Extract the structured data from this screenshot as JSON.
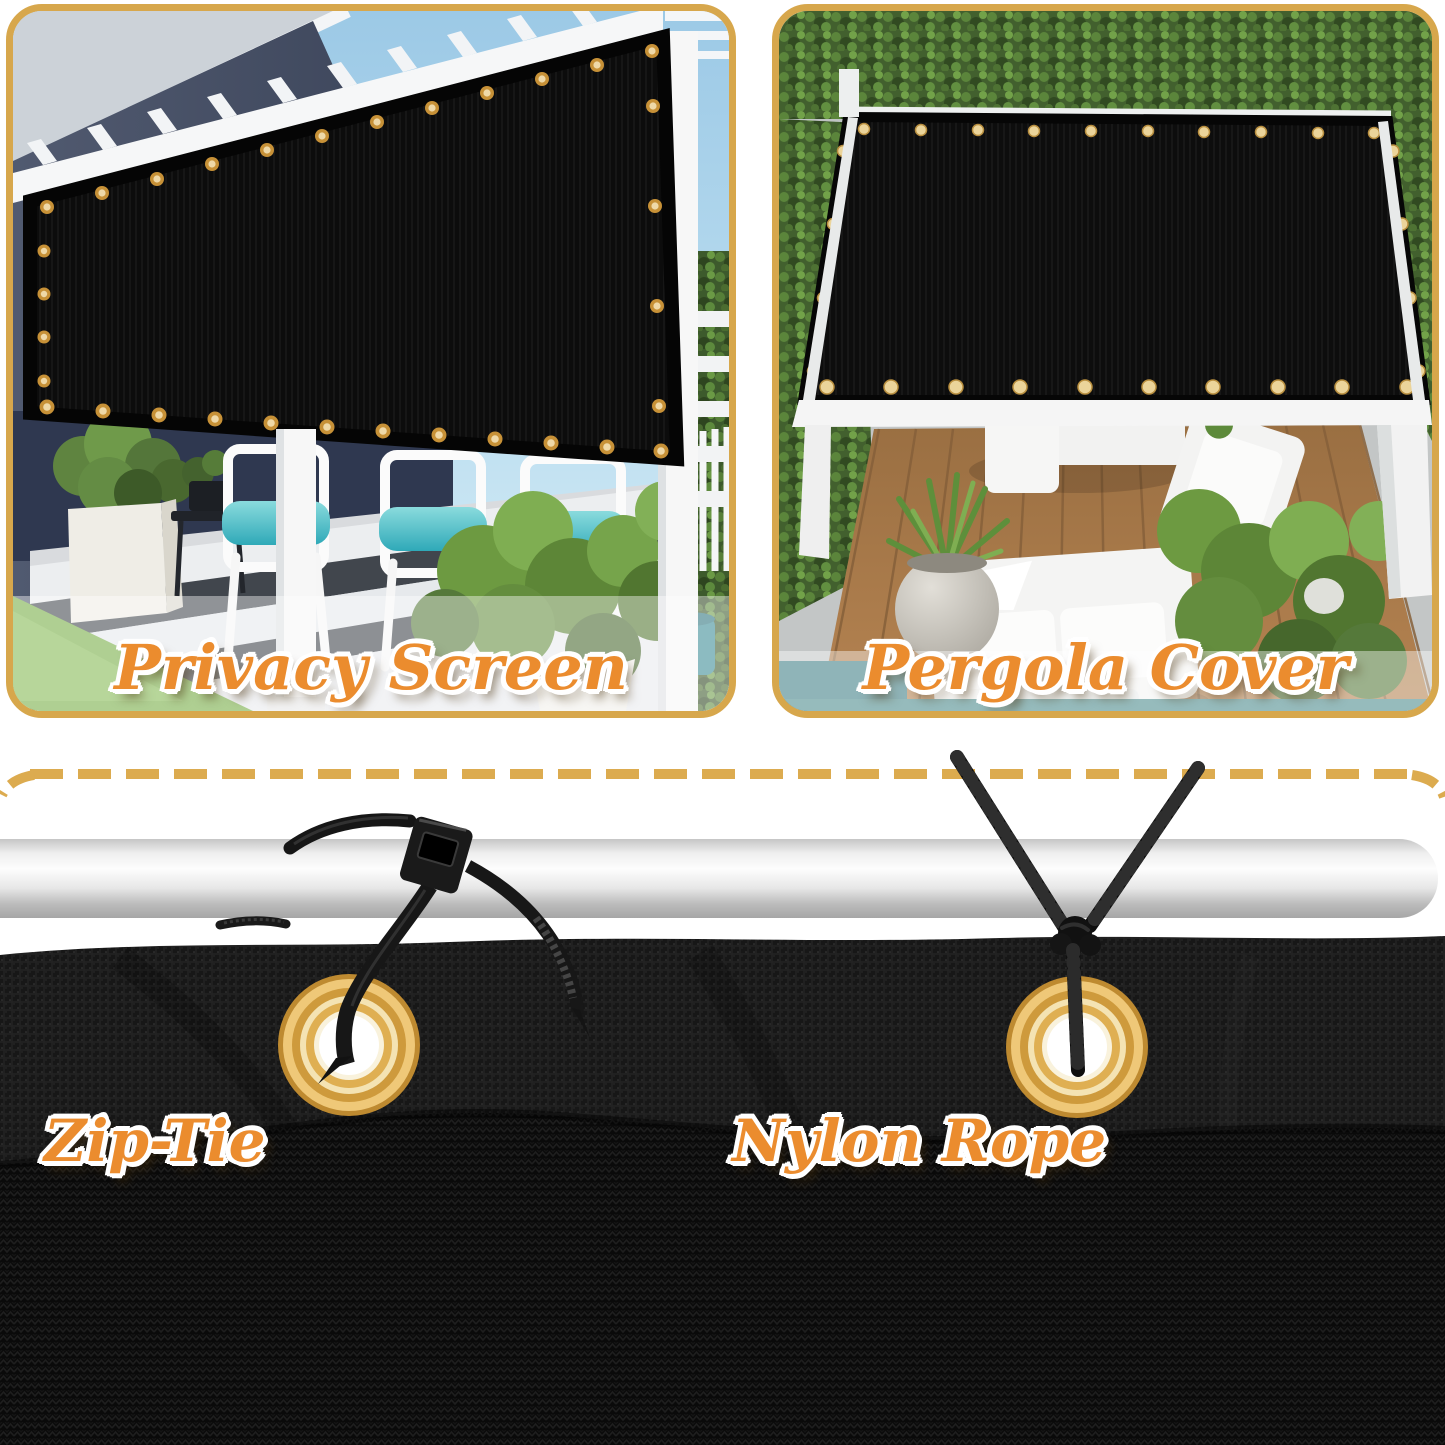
{
  "panels": {
    "privacy": {
      "caption": "Privacy Screen"
    },
    "pergola": {
      "caption": "Pergola Cover"
    }
  },
  "installation": {
    "zip_tie_label": "Zip-Tie",
    "nylon_rope_label": "Nylon Rope"
  },
  "colors": {
    "caption_orange": "#EB8C2E",
    "panel_border_gold": "#D7A74C",
    "dash_gold": "#DCAB4F",
    "grommet_gold": "#D79A3C",
    "fabric_black": "#0D0D0D",
    "cushion_teal": "#3FB6C2",
    "pool_teal": "#4A8A8C"
  }
}
